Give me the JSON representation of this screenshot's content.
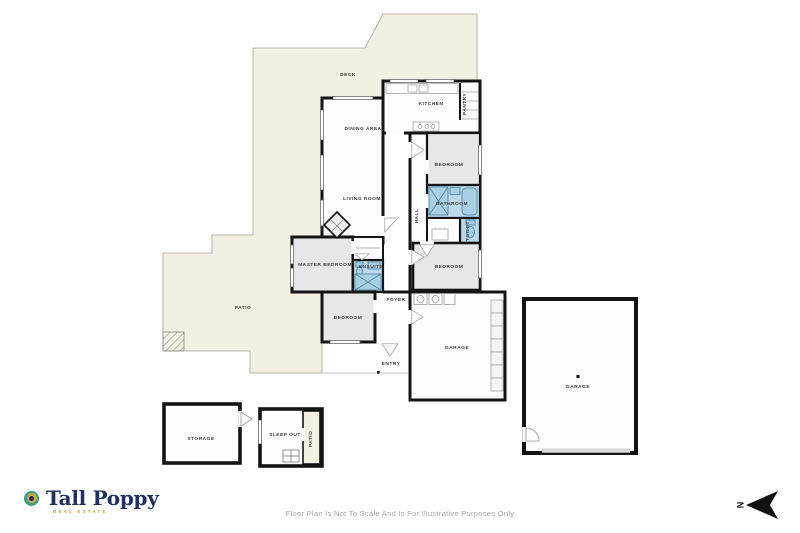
{
  "floor_plan": {
    "labels": {
      "deck": "DECK",
      "kitchen": "KITCHEN",
      "pantry": "PANTRY",
      "dining": "DINING AREA",
      "bedroom_top": "BEDROOM",
      "living": "LIVING ROOM",
      "bathroom": "BATHROOM",
      "hall": "HALL",
      "toilet": "TOILET",
      "master": "MASTER BEDROOM",
      "ensuite": "ENSUITE",
      "bedroom_right": "BEDROOM",
      "foyer": "FOYER",
      "patio": "PATIO",
      "bedroom_lower": "BEDROOM",
      "garage_attached": "GARAGE",
      "entry": "ENTRY",
      "garage_detached": "GARAGE",
      "storage": "STORAGE",
      "sleep_out": "SLEEP OUT",
      "sleep_out_patio": "PATIO"
    },
    "colors": {
      "outdoor": "#f2f0e2",
      "room_white": "#fdfdfd",
      "bedroom_gray": "#e7e7e7",
      "wet_area_blue": "#bcd9ea",
      "wall": "#141414"
    }
  },
  "footer": {
    "logo": {
      "name": "Tall Poppy",
      "tagline": "REAL ESTATE",
      "navy": "#22305e",
      "gold": "#c09a3e",
      "teal": "#3c9a8e"
    },
    "disclaimer": "Floor Plan Is Not To Scale And Is For Illustrative Purposes Only",
    "compass": {
      "label": "N"
    }
  }
}
